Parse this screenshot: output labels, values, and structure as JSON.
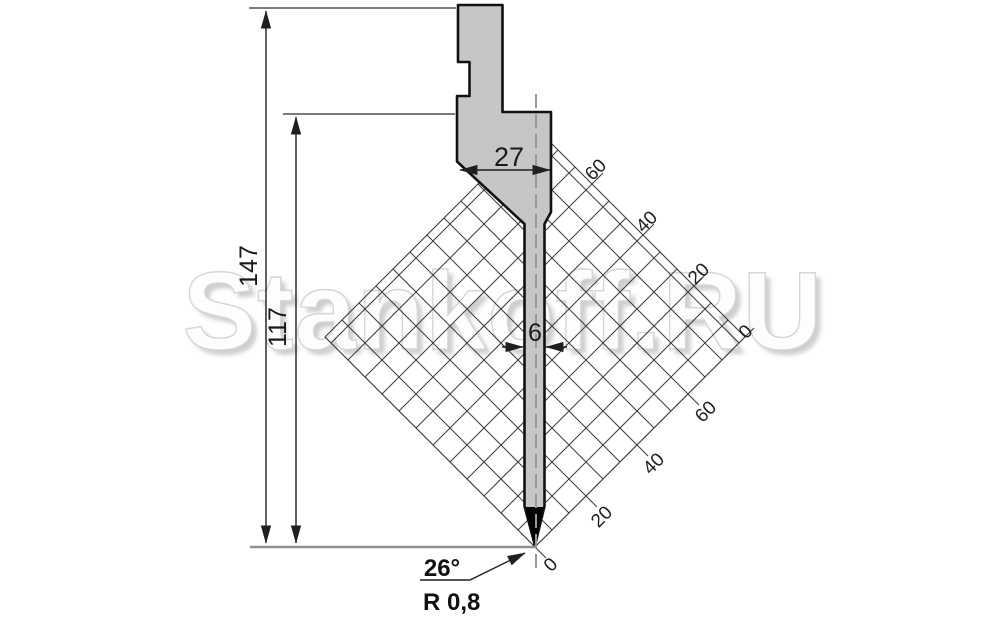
{
  "drawing": {
    "dims": {
      "total_height": "147",
      "working_height": "117",
      "body_width": "27",
      "blade_width": "6",
      "tip_angle": "26°",
      "tip_radius": "R 0,8"
    },
    "grid": {
      "upper_labels": [
        "60",
        "40",
        "20",
        "0"
      ],
      "lower_labels": [
        "60",
        "40",
        "20",
        "0"
      ]
    },
    "watermark": {
      "text": "Stankoff.RU"
    },
    "colors": {
      "punch_fill": "#c6c6c6",
      "tip_fill": "#000000",
      "watermark_face": "#fdfdfd",
      "watermark_shadow": "#bdbdbd"
    }
  }
}
